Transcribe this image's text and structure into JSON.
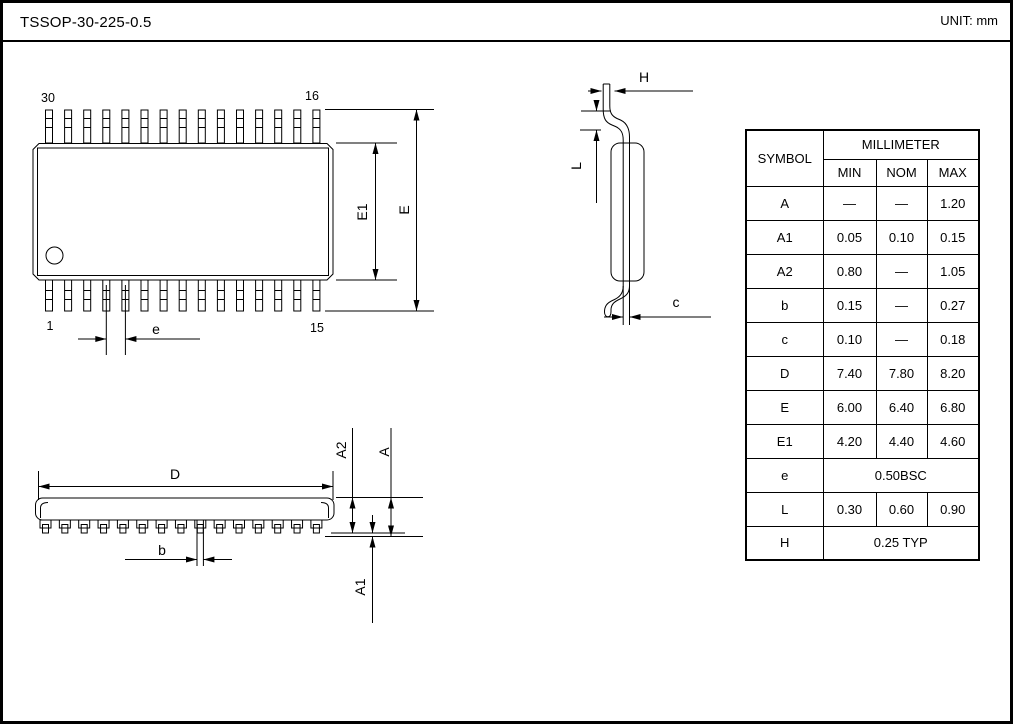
{
  "header": {
    "title": "TSSOP-30-225-0.5",
    "unit": "UNIT: mm"
  },
  "top_view": {
    "pin_top_left": "30",
    "pin_top_right": "16",
    "pin_bottom_left": "1",
    "pin_bottom_right": "15",
    "dim_e1": "E1",
    "dim_e": "E",
    "dim_pitch": "e"
  },
  "side_view": {
    "dim_h": "H",
    "dim_l": "L",
    "dim_c": "c"
  },
  "front_view": {
    "dim_d": "D",
    "dim_b": "b",
    "dim_a2": "A2",
    "dim_a": "A",
    "dim_a1": "A1"
  },
  "table": {
    "symbol_header": "SYMBOL",
    "unit_header": "MILLIMETER",
    "col_headers": [
      "MIN",
      "NOM",
      "MAX"
    ],
    "rows": [
      {
        "symbol": "A",
        "min": "—",
        "nom": "—",
        "max": "1.20"
      },
      {
        "symbol": "A1",
        "min": "0.05",
        "nom": "0.10",
        "max": "0.15"
      },
      {
        "symbol": "A2",
        "min": "0.80",
        "nom": "—",
        "max": "1.05"
      },
      {
        "symbol": "b",
        "min": "0.15",
        "nom": "—",
        "max": "0.27"
      },
      {
        "symbol": "c",
        "min": "0.10",
        "nom": "—",
        "max": "0.18"
      },
      {
        "symbol": "D",
        "min": "7.40",
        "nom": "7.80",
        "max": "8.20"
      },
      {
        "symbol": "E",
        "min": "6.00",
        "nom": "6.40",
        "max": "6.80"
      },
      {
        "symbol": "E1",
        "min": "4.20",
        "nom": "4.40",
        "max": "4.60"
      },
      {
        "symbol": "e",
        "span": "0.50BSC"
      },
      {
        "symbol": "L",
        "min": "0.30",
        "nom": "0.60",
        "max": "0.90"
      },
      {
        "symbol": "H",
        "span": "0.25 TYP"
      }
    ]
  }
}
